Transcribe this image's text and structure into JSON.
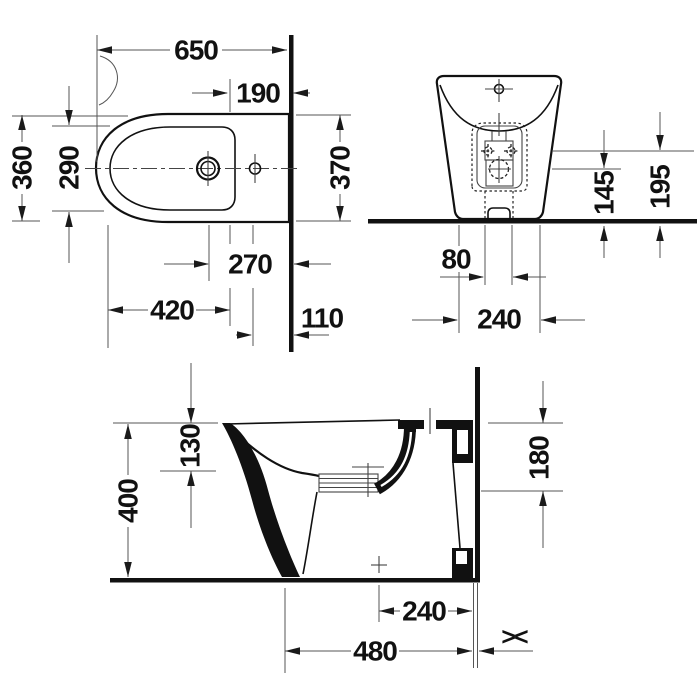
{
  "page": {
    "title": "Bidet dimension drawing",
    "background": "#ffffff"
  },
  "colors": {
    "line": "#111111",
    "thin_line": "#555555",
    "background": "#ffffff"
  },
  "drawing": {
    "subject": "floor-standing back-to-wall bidet, three-view dimension drawing"
  },
  "views": {
    "plan": {
      "dims": {
        "overall_length": "650",
        "rim_to_wall": "190",
        "overall_width": "360",
        "bowl_width": "290",
        "wall_side_width": "370",
        "tap_hole_to_wall": "270",
        "hole_span": "420",
        "side_hole_to_wall": "110"
      }
    },
    "front": {
      "dims": {
        "drain_height": "145",
        "fixing_height": "195",
        "bolt_span": "80",
        "base_width": "240"
      }
    },
    "side": {
      "dims": {
        "rim_drop": "130",
        "overall_height": "400",
        "rear_height": "180",
        "outlet_to_wall": "240",
        "overall_depth": "480",
        "flush_to_wall_symbol": "><"
      }
    }
  }
}
